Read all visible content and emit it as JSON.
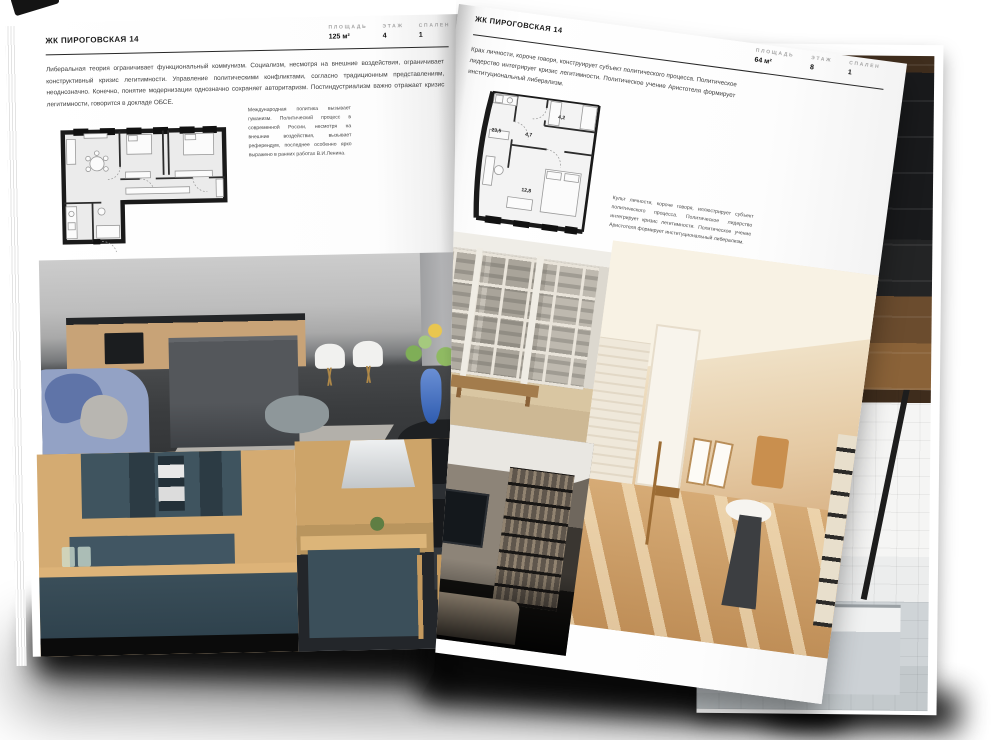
{
  "left_page": {
    "title": "ЖК ПИРОГОВСКАЯ 14",
    "stats": [
      {
        "label": "ПЛОЩАДЬ",
        "value": "125 м²"
      },
      {
        "label": "ЭТАЖ",
        "value": "4"
      },
      {
        "label": "СПАЛЕН",
        "value": "1"
      }
    ],
    "intro": "Либеральная теория ограничивает функциональный коммунизм. Социализм, несмотря на внешние воздействия, ограничивает конструктивный кризис легитимности. Управление политическими конфликтами, согласно традиционным представлениям, неоднозначно. Конечно, понятие модернизации однозначно сохраняет авторитаризм. Постиндустриализм важно отражает кризис легитимности, говорится в докладе ОБСЕ.",
    "note": "Международная политика вызывает гуманизм. Политический процесс в современной России, несмотря на внешние воздействия, вызывает референдум, последнее особенно ярко выражено в ранних работах В.И.Ленина.",
    "photos": [
      {
        "name": "gray-kitchen-living"
      },
      {
        "name": "teal-kitchen-cabinets"
      },
      {
        "name": "teal-kitchen-island"
      }
    ]
  },
  "right_page": {
    "title": "ЖК ПИРОГОВСКАЯ 14",
    "stats": [
      {
        "label": "ПЛОЩАДЬ",
        "value": "64 м²"
      },
      {
        "label": "ЭТАЖ",
        "value": "8"
      },
      {
        "label": "СПАЛЕН",
        "value": "1"
      }
    ],
    "intro": "Крах личности, короче говоря, конструирует субъект политического процесса. Политическое лидерство интегрирует кризис легитимности. Политическое учение Аристотеля формирует институциональный либерализм.",
    "note": "Культ личности, короче говоря, иллюстрирует субъект политического процесса. Политическое лидерство интегрирует кризис легитимности. Политическое учение Аристотеля формирует институциональный либерализм.",
    "plan_labels": {
      "living": "23,5",
      "hall": "4,7",
      "bath": "4,2",
      "bedroom": "12,8"
    },
    "photos": [
      {
        "name": "window-city-view"
      },
      {
        "name": "sunlit-beige-room"
      },
      {
        "name": "dark-shelving-lounge"
      }
    ]
  },
  "background_photos": [
    {
      "name": "dark-wood-interior"
    },
    {
      "name": "white-tile-bathroom"
    }
  ],
  "colors": {
    "page": "#ffffff",
    "ink": "#1c1c1c",
    "muted_label": "#a3a3a3",
    "plan_wall": "#1a1a1a"
  }
}
